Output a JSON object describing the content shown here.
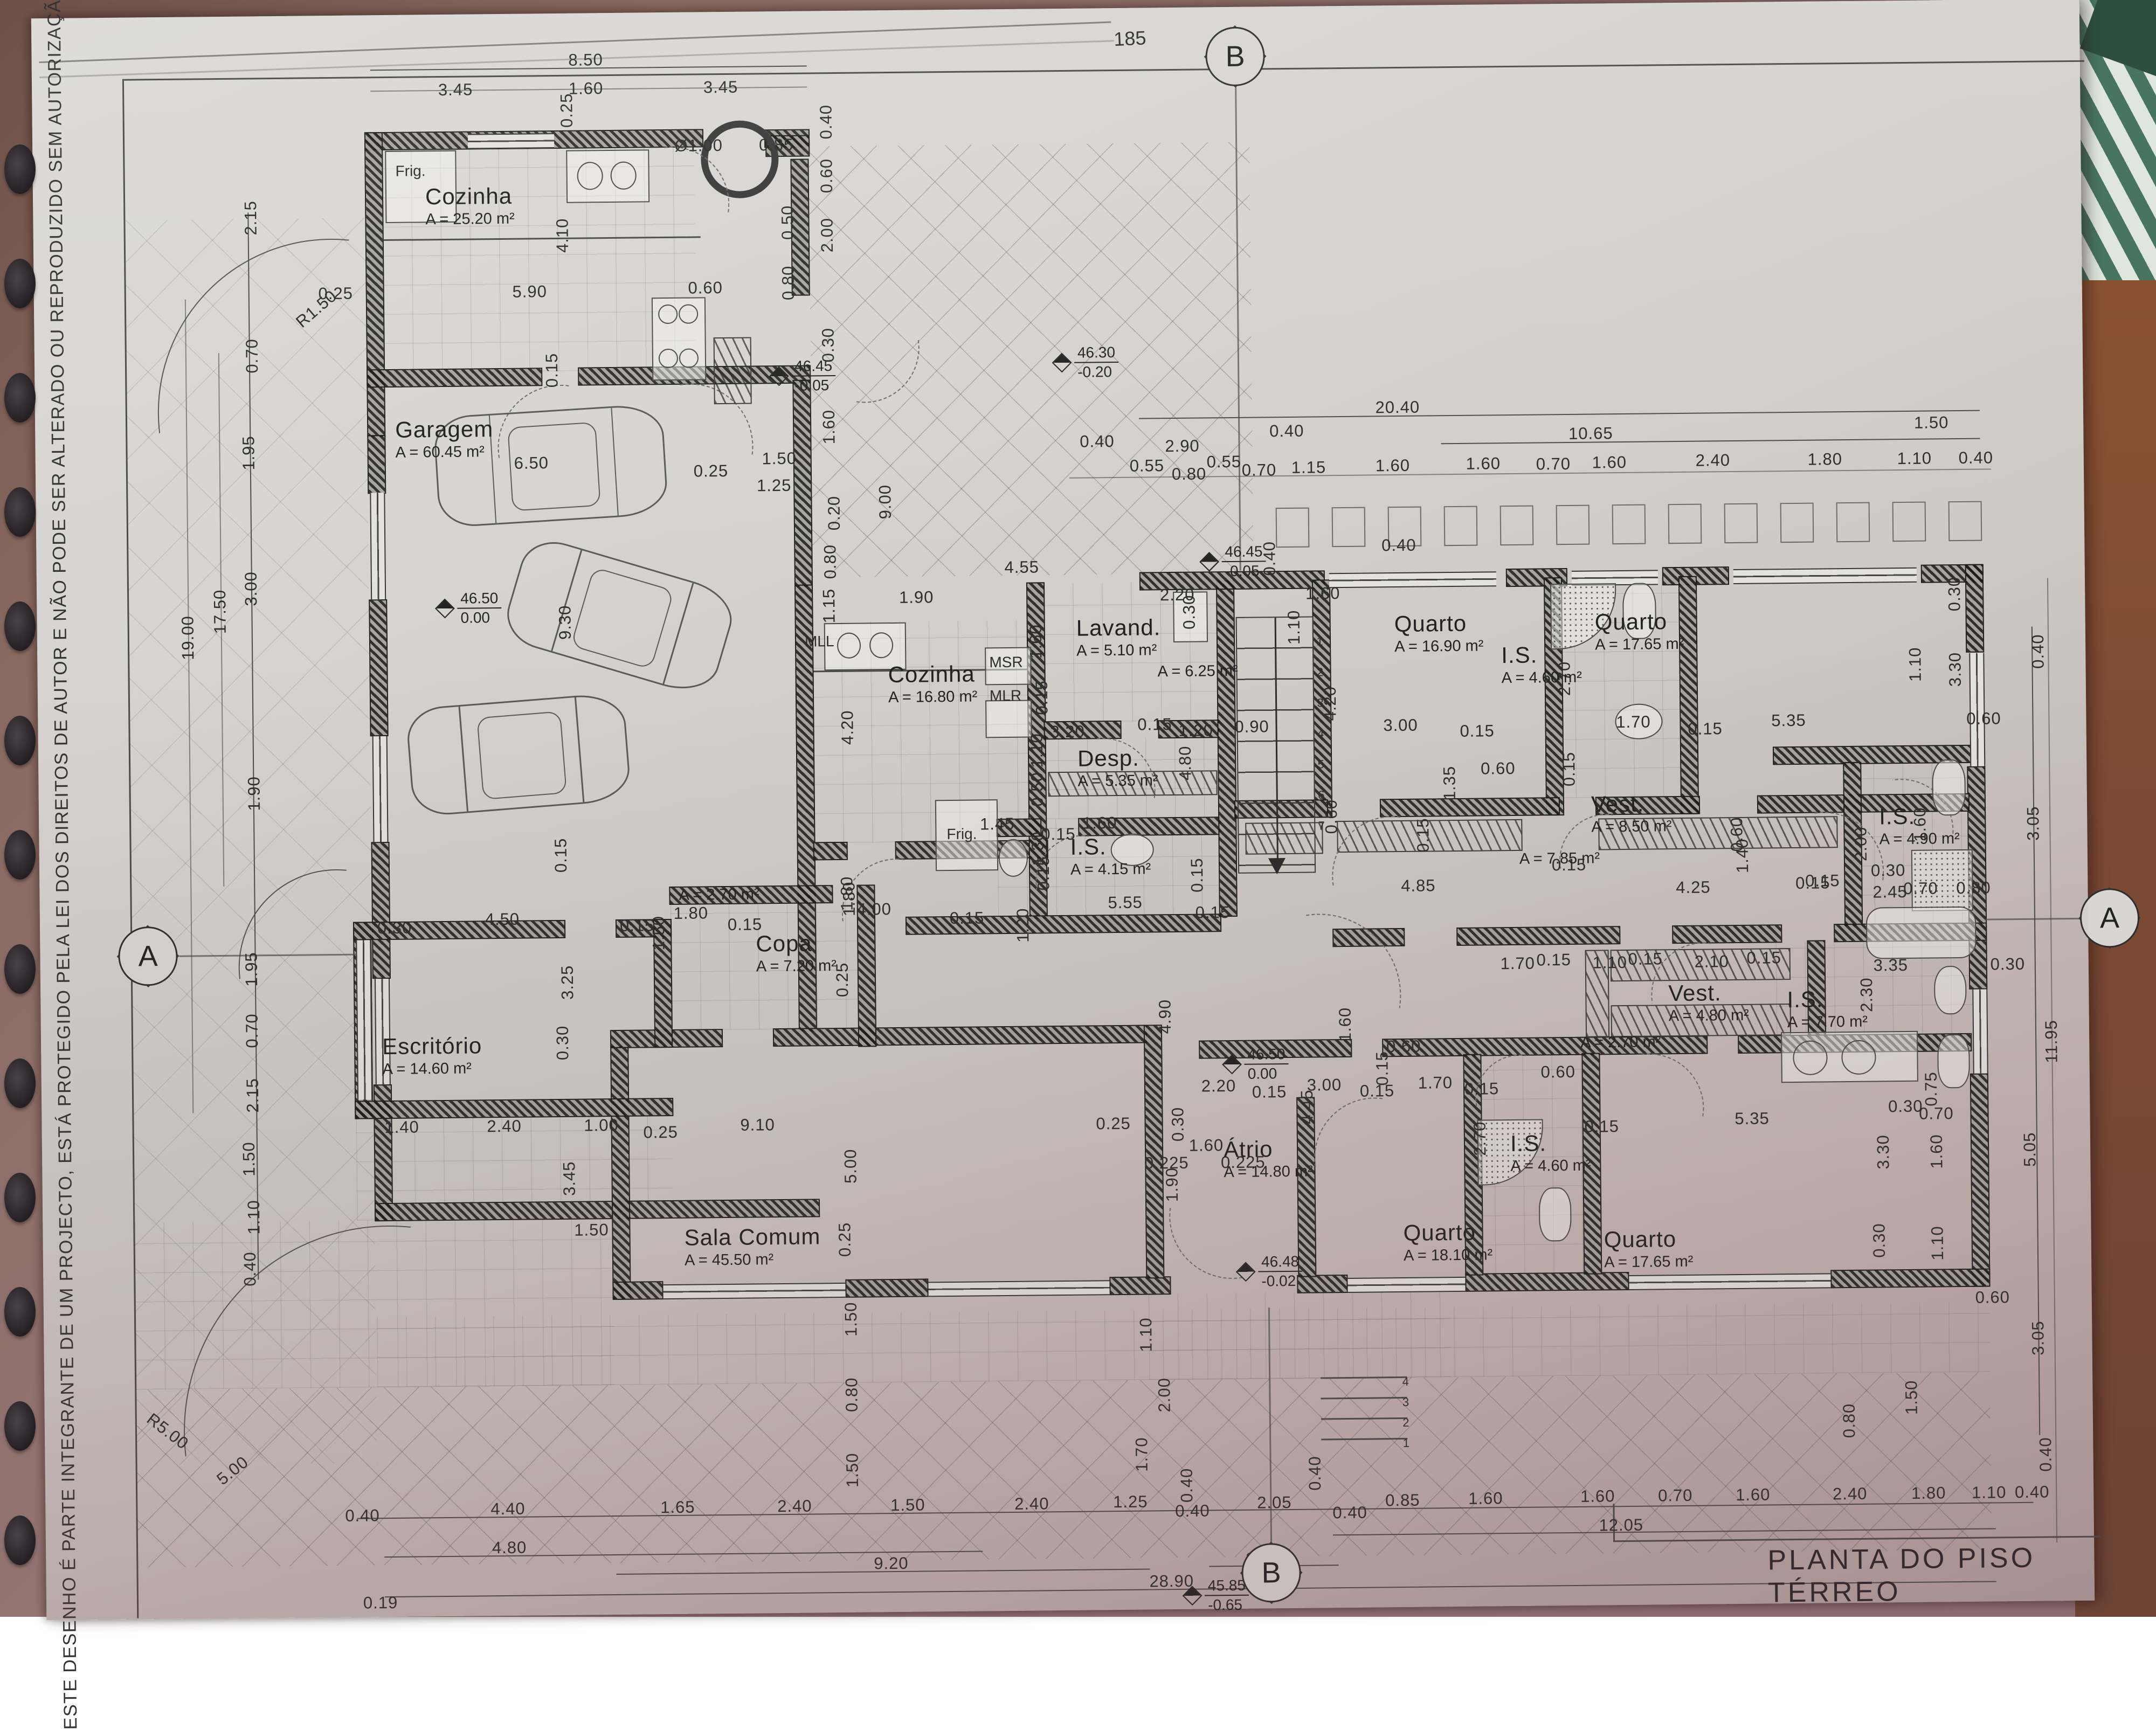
{
  "sheet": {
    "page_number": "185",
    "title": "PLANTA DO PISO TÉRREO",
    "copyright": "ESTE DESENHO É PARTE INTEGRANTE DE UM PROJECTO, ESTÁ PROTEGIDO PELA LEI DOS DIREITOS DE AUTOR E NÃO PODE SER ALTERADO OU REPRODUZIDO SEM AUTORIZAÇÃO PRÉVIA"
  },
  "section_markers": [
    [
      "B",
      2305,
      108
    ],
    [
      "B",
      2345,
      2922
    ],
    [
      "A",
      272,
      1758
    ],
    [
      "A",
      3912,
      1722
    ]
  ],
  "levels": [
    [
      "46.45",
      "-0.05",
      1440,
      660
    ],
    [
      "46.30",
      "-0.20",
      1965,
      640
    ],
    [
      "46.50",
      "0.00",
      816,
      1085
    ],
    [
      "46.45",
      "-0.05",
      2235,
      1012
    ],
    [
      "46.50",
      "0.00",
      2268,
      1945
    ],
    [
      "46.48",
      "-0.02",
      2290,
      2330
    ],
    [
      "45.85",
      "-0.65",
      2185,
      2930
    ]
  ],
  "rooms": [
    [
      "Cozinha",
      "A = 25.20 m²",
      800,
      330
    ],
    [
      "Garagem",
      "A = 60.45 m²",
      740,
      762
    ],
    [
      "Cozinha",
      "A = 16.80 m²",
      1650,
      1225
    ],
    [
      "Lavand.",
      "A = 5.10 m²",
      2000,
      1142
    ],
    [
      "",
      "A = 6.25 m²",
      2150,
      1230
    ],
    [
      "Desp.",
      "A = 5.35 m²",
      2000,
      1384
    ],
    [
      "I.S.",
      "A = 4.15 m²",
      1985,
      1548
    ],
    [
      "Copa",
      "A = 7.20 m²",
      1400,
      1722
    ],
    [
      "",
      "A = 2.70 m²",
      1258,
      1636
    ],
    [
      "",
      "A = 2.70 m²",
      2928,
      1926
    ],
    [
      "Escritório",
      "A = 14.60 m²",
      705,
      1906
    ],
    [
      "Sala Comum",
      "A = 45.50 m²",
      1262,
      2266
    ],
    [
      "Átrio",
      "A = 14.80 m²",
      2264,
      2112
    ],
    [
      "Quarto",
      "A = 16.90 m²",
      2590,
      1140
    ],
    [
      "I.S.",
      "A = 4.60 m²",
      2788,
      1200
    ],
    [
      "Quarto",
      "A = 17.65 m²",
      2962,
      1140
    ],
    [
      "Vest.",
      "A = 8.50 m²",
      2952,
      1478
    ],
    [
      "",
      "A = 7.85 m²",
      2818,
      1584
    ],
    [
      "I.S.",
      "A = 4.90 m²",
      3486,
      1506
    ],
    [
      "Vest.",
      "A = 4.80 m²",
      3092,
      1830
    ],
    [
      "I.S.",
      "A = 7.70 m²",
      3312,
      1844
    ],
    [
      "Quarto",
      "A = 18.10 m²",
      2596,
      2270
    ],
    [
      "I.S.",
      "A = 4.60 m²",
      2796,
      2106
    ],
    [
      "Quarto",
      "A = 17.65 m²",
      2968,
      2286
    ]
  ],
  "fixtures": [
    [
      "Frig.",
      745,
      290
    ],
    [
      "MLL",
      1496,
      1170
    ],
    [
      "MSR",
      1838,
      1212
    ],
    [
      "MLR",
      1838,
      1274
    ],
    [
      "Frig.",
      1756,
      1530
    ]
  ],
  "dims": [
    [
      "8.50",
      1100,
      103
    ],
    [
      "3.45",
      858,
      156
    ],
    [
      "1.60",
      1100,
      156
    ],
    [
      "3.45",
      1350,
      156
    ],
    [
      "0.25",
      1064,
      196,
      -90
    ],
    [
      "Ø1.00",
      1308,
      264
    ],
    [
      "0.85",
      1452,
      264
    ],
    [
      "0.40",
      1545,
      222,
      -90
    ],
    [
      "0.60",
      1545,
      322,
      -90
    ],
    [
      "0.50",
      1472,
      408,
      -90
    ],
    [
      "0.80",
      1472,
      520,
      -90
    ],
    [
      "4.10",
      1054,
      428,
      -90
    ],
    [
      "5.90",
      992,
      532
    ],
    [
      "0.60",
      1318,
      528
    ],
    [
      "0.25",
      632,
      532
    ],
    [
      "R1.50",
      596,
      560,
      -40
    ],
    [
      "0.15",
      1032,
      678,
      -90
    ],
    [
      "2.00",
      1545,
      432,
      -90
    ],
    [
      "0.30",
      1545,
      636,
      -90
    ],
    [
      "1.60",
      1545,
      788,
      -90
    ],
    [
      "0.20",
      1553,
      948,
      -90
    ],
    [
      "0.80",
      1545,
      1038,
      -90
    ],
    [
      "1.15",
      1542,
      1120,
      -90
    ],
    [
      "9.00",
      1648,
      928,
      -90
    ],
    [
      "6.50",
      992,
      850
    ],
    [
      "0.25",
      1325,
      868
    ],
    [
      "1.50",
      1452,
      846
    ],
    [
      "1.25",
      1442,
      896
    ],
    [
      "9.30",
      1052,
      1146,
      -90
    ],
    [
      "20.40",
      2600,
      762
    ],
    [
      "10.65",
      2958,
      814
    ],
    [
      "1.50",
      3590,
      800
    ],
    [
      "0.40",
      2394,
      804
    ],
    [
      "2.90",
      2200,
      830
    ],
    [
      "0.40",
      2042,
      820
    ],
    [
      "0.55",
      2134,
      866
    ],
    [
      "0.80",
      2212,
      882
    ],
    [
      "0.55",
      2277,
      860
    ],
    [
      "0.70",
      2342,
      876
    ],
    [
      "1.15",
      2434,
      872
    ],
    [
      "1.60",
      2590,
      870
    ],
    [
      "1.60",
      2758,
      868
    ],
    [
      "0.70",
      2888,
      870
    ],
    [
      "1.60",
      2992,
      868
    ],
    [
      "2.40",
      3184,
      866
    ],
    [
      "1.80",
      3392,
      866
    ],
    [
      "1.10",
      3558,
      866
    ],
    [
      "0.40",
      3672,
      866
    ],
    [
      "1.90",
      1704,
      1106
    ],
    [
      "4.55",
      1900,
      1052
    ],
    [
      "2.20",
      2188,
      1106
    ],
    [
      "1.60",
      2458,
      1106
    ],
    [
      "0.40",
      2360,
      1040,
      -90
    ],
    [
      "1.10",
      2404,
      1168,
      -90
    ],
    [
      "0.40",
      2600,
      1018
    ],
    [
      "1.60",
      1925,
      1190,
      -90
    ],
    [
      "0.30",
      2210,
      1138,
      -90
    ],
    [
      "4.20",
      1574,
      1346,
      -90
    ],
    [
      "0.15",
      1935,
      1294,
      -90
    ],
    [
      "3.20",
      1982,
      1358
    ],
    [
      "0.15",
      2144,
      1346
    ],
    [
      "1.20",
      2220,
      1358
    ],
    [
      "0.90",
      2324,
      1352
    ],
    [
      "4.80",
      2200,
      1418,
      -90
    ],
    [
      "1.10",
      1925,
      1392,
      -90
    ],
    [
      "0.50",
      1925,
      1464,
      -90
    ],
    [
      "1.45",
      1850,
      1528
    ],
    [
      "1.60",
      2040,
      1528
    ],
    [
      "0.15",
      1963,
      1548
    ],
    [
      "1.30",
      1925,
      1574,
      -90
    ],
    [
      "0.15",
      1935,
      1620,
      -90
    ],
    [
      "1.80",
      1574,
      1664,
      -90
    ],
    [
      "4.00",
      1620,
      1684
    ],
    [
      "0.15",
      1792,
      1702
    ],
    [
      "5.55",
      2086,
      1676
    ],
    [
      "1.20",
      1896,
      1716,
      -90
    ],
    [
      "0.15",
      2220,
      1626,
      -90
    ],
    [
      "0.15",
      2248,
      1696
    ],
    [
      "4.20",
      2470,
      1310,
      -90
    ],
    [
      "3.00",
      2600,
      1352
    ],
    [
      "0.15",
      2742,
      1364
    ],
    [
      "2.70",
      2905,
      1268,
      -90
    ],
    [
      "1.70",
      3032,
      1350
    ],
    [
      "0.15",
      3165,
      1364
    ],
    [
      "5.35",
      3320,
      1350
    ],
    [
      "3.30",
      3630,
      1258,
      -90
    ],
    [
      "0.30",
      3630,
      1118,
      -90
    ],
    [
      "0.15",
      2912,
      1436,
      -90
    ],
    [
      "0.60",
      2780,
      1434
    ],
    [
      "1.35",
      2690,
      1460,
      -90
    ],
    [
      "0.60",
      2470,
      1520,
      -90
    ],
    [
      "0.15",
      2640,
      1556,
      -90
    ],
    [
      "0.60",
      3222,
      1560,
      -90
    ],
    [
      "0.15",
      2910,
      1614
    ],
    [
      "4.85",
      2630,
      1650
    ],
    [
      "4.25",
      3140,
      1658
    ],
    [
      "1.40",
      3232,
      1600,
      -90
    ],
    [
      "0.15",
      3380,
      1648
    ],
    [
      "2.00",
      3452,
      1580,
      -90
    ],
    [
      "0.15",
      3362,
      1652
    ],
    [
      "2.45",
      3505,
      1670
    ],
    [
      "3.35",
      3505,
      1806
    ],
    [
      "0.30",
      3722,
      1806
    ],
    [
      "2.30",
      3460,
      1860,
      -90
    ],
    [
      "1.70",
      2813,
      1796
    ],
    [
      "0.15",
      2880,
      1790
    ],
    [
      "1.10",
      2984,
      1796
    ],
    [
      "0.15",
      3050,
      1790
    ],
    [
      "2.10",
      3173,
      1796
    ],
    [
      "0.15",
      3270,
      1790
    ],
    [
      "0.60",
      2886,
      1998
    ],
    [
      "5.35",
      3245,
      2088
    ],
    [
      "0.15",
      2966,
      2100
    ],
    [
      "3.30",
      3488,
      2152,
      -90
    ],
    [
      "0.30",
      3479,
      2316,
      -90
    ],
    [
      "1.10",
      3587,
      2322,
      -90
    ],
    [
      "1.60",
      3587,
      2152,
      -90
    ],
    [
      "0.75",
      3578,
      2036,
      -90
    ],
    [
      "0.70",
      3587,
      2082
    ],
    [
      "0.30",
      3530,
      2068
    ],
    [
      "0.80",
      3660,
      1664
    ],
    [
      "0.70",
      3562,
      1664
    ],
    [
      "0.30",
      3502,
      1630
    ],
    [
      "0.60",
      3682,
      1350
    ],
    [
      "1.10",
      3556,
      1248,
      -90
    ],
    [
      "1.60",
      3562,
      1545,
      -90
    ],
    [
      "3.05",
      3772,
      1545,
      -90
    ],
    [
      "0.40",
      3784,
      1226,
      -90
    ],
    [
      "5.05",
      3760,
      2150,
      -90
    ],
    [
      "11.95",
      3802,
      1950,
      -90
    ],
    [
      "3.05",
      3772,
      2500,
      -90
    ],
    [
      "0.40",
      3784,
      2716,
      -90
    ],
    [
      "0.60",
      3688,
      2424
    ],
    [
      "1.50",
      3536,
      2608,
      -90
    ],
    [
      "0.80",
      3420,
      2650,
      -90
    ],
    [
      "4.90",
      2158,
      1888,
      -90
    ],
    [
      "2.20",
      2256,
      2018
    ],
    [
      "0.15",
      2350,
      2030
    ],
    [
      "3.00",
      2452,
      2018
    ],
    [
      "0.15",
      2550,
      2030
    ],
    [
      "1.70",
      2658,
      2016
    ],
    [
      "0.15",
      2744,
      2028
    ],
    [
      "4.45",
      2420,
      2058,
      -90
    ],
    [
      "0.30",
      2180,
      2088,
      -90
    ],
    [
      "1.60",
      2232,
      2128
    ],
    [
      "0.225",
      2158,
      2160
    ],
    [
      "0.225",
      2300,
      2160
    ],
    [
      "1.90",
      2168,
      2200,
      -90
    ],
    [
      "2.70",
      2740,
      2120,
      -90
    ],
    [
      "1.60",
      2492,
      1906,
      -90
    ],
    [
      "0.60",
      2600,
      1948
    ],
    [
      "0.15",
      2560,
      1988,
      -90
    ],
    [
      "1.10",
      2117,
      2478,
      -90
    ],
    [
      "2.00",
      2150,
      2590,
      -90
    ],
    [
      "1.70",
      2107,
      2700,
      -90
    ],
    [
      "0.40",
      2190,
      2758,
      -90
    ],
    [
      "0.40",
      2428,
      2738,
      -90
    ],
    [
      "0.15",
      1040,
      1578,
      -90
    ],
    [
      "4.50",
      930,
      1696
    ],
    [
      "0.30",
      730,
      1710
    ],
    [
      "0.15",
      1180,
      1710
    ],
    [
      "1.50",
      1220,
      1724,
      -90
    ],
    [
      "1.80",
      1280,
      1688
    ],
    [
      "0.15",
      1380,
      1710
    ],
    [
      "3.25",
      1050,
      1814,
      -90
    ],
    [
      "0.30",
      1040,
      1926,
      -90
    ],
    [
      "1.40",
      740,
      2080
    ],
    [
      "2.40",
      930,
      2080
    ],
    [
      "1.00",
      1110,
      2080
    ],
    [
      "0.25",
      1220,
      2094
    ],
    [
      "3.45",
      1050,
      2178,
      -90
    ],
    [
      "5.00",
      1572,
      2160,
      -90
    ],
    [
      "0.25",
      1560,
      1814,
      -90
    ],
    [
      "1.80",
      1570,
      1654,
      -90
    ],
    [
      "9.10",
      1400,
      2082
    ],
    [
      "0.25",
      2060,
      2086
    ],
    [
      "1.50",
      1090,
      2274
    ],
    [
      "0.25",
      1560,
      2296,
      -90
    ],
    [
      "1.50",
      1570,
      2444,
      -90
    ],
    [
      "0.80",
      1570,
      2584,
      -90
    ],
    [
      "1.50",
      1570,
      2724,
      -90
    ],
    [
      "0.40",
      660,
      2800
    ],
    [
      "4.40",
      930,
      2790
    ],
    [
      "1.65",
      1245,
      2790
    ],
    [
      "2.40",
      1462,
      2790
    ],
    [
      "1.50",
      1672,
      2790
    ],
    [
      "2.40",
      1902,
      2790
    ],
    [
      "1.25",
      2085,
      2788
    ],
    [
      "0.40",
      2200,
      2806
    ],
    [
      "2.05",
      2352,
      2792
    ],
    [
      "0.40",
      2492,
      2812
    ],
    [
      "0.85",
      2590,
      2790
    ],
    [
      "1.60",
      2744,
      2788
    ],
    [
      "1.60",
      2952,
      2786
    ],
    [
      "0.70",
      3096,
      2786
    ],
    [
      "1.60",
      3240,
      2786
    ],
    [
      "2.40",
      3420,
      2786
    ],
    [
      "1.80",
      3566,
      2786
    ],
    [
      "1.10",
      3678,
      2786
    ],
    [
      "0.40",
      3758,
      2786
    ],
    [
      "4.80",
      932,
      2862
    ],
    [
      "9.20",
      1640,
      2898
    ],
    [
      "2.85",
      2330,
      2896
    ],
    [
      "12.05",
      2995,
      2840
    ],
    [
      "28.90",
      2160,
      2936
    ],
    [
      "0.19",
      692,
      2962
    ],
    [
      "5.00",
      420,
      2714,
      -38
    ],
    [
      "R5.00",
      300,
      2640,
      38
    ],
    [
      "2.15",
      476,
      390,
      -90
    ],
    [
      "0.70",
      476,
      646,
      -90
    ],
    [
      "1.95",
      468,
      826,
      -90
    ],
    [
      "3.00",
      470,
      1078,
      -90
    ],
    [
      "17.50",
      412,
      1120,
      -90
    ],
    [
      "19.00",
      352,
      1168,
      -90
    ],
    [
      "1.90",
      472,
      1458,
      -90
    ],
    [
      "1.95",
      464,
      1784,
      -90
    ],
    [
      "0.70",
      464,
      1898,
      -90
    ],
    [
      "2.15",
      464,
      2018,
      -90
    ],
    [
      "1.50",
      456,
      2136,
      -90
    ],
    [
      "1.10",
      464,
      2244,
      -90
    ],
    [
      "0.40",
      456,
      2340,
      -90
    ],
    [
      "1",
      2452,
      1195,
      0,
      1
    ],
    [
      "2",
      2452,
      1252,
      0,
      1
    ],
    [
      "3",
      2452,
      1309,
      0,
      1
    ],
    [
      "4",
      2452,
      1366,
      0,
      1
    ],
    [
      "5",
      2452,
      1423,
      0,
      1
    ],
    [
      "6",
      2452,
      1480,
      0,
      1
    ],
    [
      "7",
      2452,
      1537,
      0,
      1
    ],
    [
      "1",
      2598,
      2684,
      0,
      1
    ],
    [
      "2",
      2598,
      2646,
      0,
      1
    ],
    [
      "3",
      2598,
      2608,
      0,
      1
    ],
    [
      "4",
      2598,
      2570,
      0,
      1
    ]
  ],
  "colors": {
    "paper": "#d6d4d0",
    "line": "#3d3d3d",
    "wall": "#1d1d1d",
    "background": "#8a6a60"
  }
}
